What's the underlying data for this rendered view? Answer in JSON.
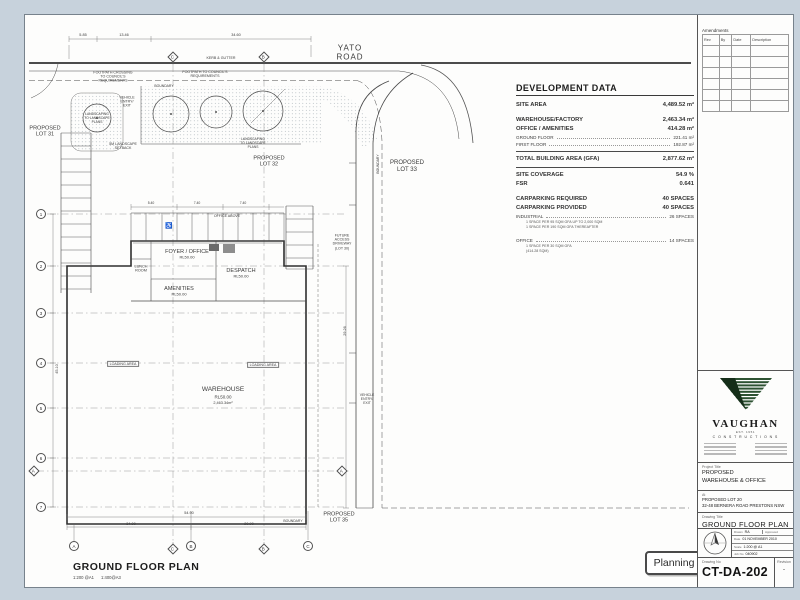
{
  "colors": {
    "page_bg": "#c7d2dc",
    "sheet": "#fdfdfc",
    "ink": "#3c3c3c",
    "logo_stripe_green": "#2d5232",
    "logo_solid": "#152e19",
    "stamp_border": "#4a4a4a"
  },
  "plan_title": {
    "text": "GROUND FLOOR PLAN",
    "scale": "1:200 @A1      1:400@A3"
  },
  "stamp": {
    "label": "Planning"
  },
  "development_data": {
    "title": "DEVELOPMENT DATA",
    "rows": [
      {
        "t": "r",
        "label": "SITE AREA",
        "value": "4,489.52 m²"
      },
      {
        "t": "gap"
      },
      {
        "t": "r",
        "label": "WAREHOUSE/FACTORY",
        "value": "2,463.34 m²"
      },
      {
        "t": "r",
        "label": "OFFICE / AMENITIES",
        "value": "414.28 m²"
      },
      {
        "t": "s",
        "label": "GROUND FLOOR",
        "value": "221.41 m²"
      },
      {
        "t": "s",
        "label": "FIRST FLOOR",
        "value": "192.87 m²"
      },
      {
        "t": "rule"
      },
      {
        "t": "r",
        "label": "TOTAL BUILDING AREA (GFA)",
        "value": "2,877.62 m²"
      },
      {
        "t": "rule"
      },
      {
        "t": "r",
        "label": "SITE COVERAGE",
        "value": "54.9 %"
      },
      {
        "t": "r",
        "label": "FSR",
        "value": "0.641"
      },
      {
        "t": "gap"
      },
      {
        "t": "r",
        "label": "CARPARKING REQUIRED",
        "value": "40 SPACES"
      },
      {
        "t": "r",
        "label": "CARPARKING PROVIDED",
        "value": "40 SPACES"
      },
      {
        "t": "s",
        "label": "INDUSTRIAL",
        "value": "26 SPACES"
      },
      {
        "t": "n",
        "label": "1 SPACE PER 95 SQM GFA UP TO 2,000 SQM"
      },
      {
        "t": "n",
        "label": "1 SPACE PER 190 SQM GFA THEREAFTER"
      },
      {
        "t": "gap"
      },
      {
        "t": "s",
        "label": "OFFICE",
        "value": "14 SPACES"
      },
      {
        "t": "n",
        "label": "1 SPACE PER 30 SQM GFA"
      },
      {
        "t": "n",
        "label": "(414.28 SQM)"
      }
    ]
  },
  "titleblock": {
    "amendments": {
      "title": "Amendments",
      "columns": [
        "Rev",
        "By",
        "Date",
        "Description"
      ],
      "empty_rows": 6
    },
    "logo": {
      "name": "VAUGHAN",
      "est": "EST. 1951",
      "sub": "C O N S T R U C T I O N S"
    },
    "project_label": "Project Title",
    "project_line1": "PROPOSED",
    "project_line2": "WAREHOUSE & OFFICE",
    "at_label": "At",
    "at_line1": "PROPOSED LOT 20",
    "at_line2": "32-48 BERNERA ROAD PRESTONS NSW",
    "drawing_title_label": "Drawing Title",
    "drawing_title": "GROUND FLOOR PLAN",
    "fields": {
      "drawn_label": "Drawn",
      "drawn": "RA",
      "approved_label": "Approved",
      "approved": "",
      "date_label": "Date",
      "date": "01 NOVEMBER 2010",
      "scale_label": "Scale",
      "scale": "1:200 @ A1",
      "job_label": "Job No",
      "job": "040902"
    },
    "drawing_no_label": "Drawing No",
    "drawing_no": "CT-DA-202",
    "revision_label": "Revision",
    "revision": "-"
  },
  "plan": {
    "labels": [
      {
        "n": "yato-road-label",
        "t": "YATO\nROAD",
        "x": 349,
        "y": 52,
        "s": 8,
        "ls": 1
      },
      {
        "n": "lot-31-label",
        "t": "PROPOSED\nLOT 31",
        "x": 44,
        "y": 131,
        "s": 5.5
      },
      {
        "n": "lot-32-label",
        "t": "PROPOSED\nLOT 32",
        "x": 268,
        "y": 161,
        "s": 5.5
      },
      {
        "n": "lot-33-label",
        "t": "PROPOSED\nLOT 33",
        "x": 406,
        "y": 166,
        "s": 6
      },
      {
        "n": "lot-35-label",
        "t": "PROPOSED\nLOT 35",
        "x": 338,
        "y": 517,
        "s": 5.5
      },
      {
        "n": "warehouse-label",
        "t": "WAREHOUSE",
        "x": 222,
        "y": 389,
        "s": 6.5
      },
      {
        "n": "warehouse-rl-label",
        "t": "RL50.00",
        "x": 222,
        "y": 396,
        "s": 4.5
      },
      {
        "n": "warehouse-area-label",
        "t": "2,463.34m²",
        "x": 222,
        "y": 402,
        "s": 3.8
      },
      {
        "n": "foyer-office-label",
        "t": "FOYER / OFFICE",
        "x": 186,
        "y": 251,
        "s": 5.5
      },
      {
        "n": "foyer-office-rl-label",
        "t": "RL50.00",
        "x": 186,
        "y": 257,
        "s": 4
      },
      {
        "n": "despatch-label",
        "t": "DESPATCH",
        "x": 240,
        "y": 270,
        "s": 5.5
      },
      {
        "n": "despatch-rl-label",
        "t": "RL50.00",
        "x": 240,
        "y": 276,
        "s": 4
      },
      {
        "n": "amenities-label",
        "t": "AMENITIES",
        "x": 178,
        "y": 288,
        "s": 5.5
      },
      {
        "n": "amenities-rl-label",
        "t": "RL50.00",
        "x": 178,
        "y": 294,
        "s": 4
      },
      {
        "n": "lunch-room-label",
        "t": "LUNCH\nROOM",
        "x": 140,
        "y": 268,
        "s": 3.8
      },
      {
        "n": "office-above-label",
        "t": "OFFICE ABOVE",
        "x": 226,
        "y": 215,
        "s": 3.6
      },
      {
        "n": "loading-area-1-label",
        "t": "LOADING AREA",
        "x": 122,
        "y": 363,
        "s": 3.6,
        "box": true
      },
      {
        "n": "loading-area-2-label",
        "t": "LOADING AREA",
        "x": 262,
        "y": 364,
        "s": 3.6,
        "box": true
      },
      {
        "n": "kerb-gutter-label",
        "t": "KERB & GUTTER",
        "x": 220,
        "y": 57,
        "s": 3.6
      },
      {
        "n": "footpath-crossing-label",
        "t": "FOOTPATH CROSSING\nTO COUNCIL'S\nREQUIREMENTS",
        "x": 112,
        "y": 76,
        "s": 3.6
      },
      {
        "n": "footpath-label",
        "t": "FOOTPATH TO COUNCIL'S\nREQUIREMENTS",
        "x": 204,
        "y": 73,
        "s": 3.6
      },
      {
        "n": "boundary-top-label",
        "t": "BOUNDARY",
        "x": 163,
        "y": 85,
        "s": 3.4
      },
      {
        "n": "boundary-right-label",
        "t": "BOUNDARY",
        "x": 377,
        "y": 163,
        "s": 3.4,
        "rot": -90
      },
      {
        "n": "boundary-bottom-label",
        "t": "BOUNDARY",
        "x": 292,
        "y": 520,
        "s": 3.4
      },
      {
        "n": "vehicle-entry-top-label",
        "t": "VEHICLE\nENTRY/\nEXIT",
        "x": 126,
        "y": 101,
        "s": 3.6
      },
      {
        "n": "landscaping-1-label",
        "t": "LANDSCAPING\nTO LANDSCAPE\nPLANS",
        "x": 96,
        "y": 118,
        "s": 3.3
      },
      {
        "n": "landscaping-2-label",
        "t": "LANDSCAPING\nTO LANDSCAPE\nPLANS",
        "x": 252,
        "y": 143,
        "s": 3.3
      },
      {
        "n": "landscape-setback-label",
        "t": "5M LANDSCAPE\nSETBACK",
        "x": 122,
        "y": 145,
        "s": 3.6
      },
      {
        "n": "future-access-label",
        "t": "FUTURE\nACCESS\nDRIVEWAY\n(LOT 30)",
        "x": 341,
        "y": 241,
        "s": 3.6
      },
      {
        "n": "vehicle-entry-right-label",
        "t": "VEHICLE\nENTRY/\nEXIT",
        "x": 366,
        "y": 398,
        "s": 3.4
      },
      {
        "n": "dim-top-1",
        "t": "5.85",
        "x": 82,
        "y": 34,
        "s": 3.8
      },
      {
        "n": "dim-top-2",
        "t": "13.46",
        "x": 123,
        "y": 34,
        "s": 3.8
      },
      {
        "n": "dim-top-3",
        "t": "34.60",
        "x": 235,
        "y": 34,
        "s": 3.8
      },
      {
        "n": "dim-park-1",
        "t": "5.40",
        "x": 150,
        "y": 202,
        "s": 3.4
      },
      {
        "n": "dim-park-2",
        "t": "7.40",
        "x": 196,
        "y": 202,
        "s": 3.4
      },
      {
        "n": "dim-park-3",
        "t": "7.40",
        "x": 242,
        "y": 202,
        "s": 3.4
      },
      {
        "n": "dim-bottom-total",
        "t": "54.90",
        "x": 188,
        "y": 512,
        "s": 3.8
      },
      {
        "n": "dim-bottom-1",
        "t": "34.00",
        "x": 130,
        "y": 523,
        "s": 3.8
      },
      {
        "n": "dim-bottom-2",
        "t": "20.90",
        "x": 248,
        "y": 523,
        "s": 3.8
      },
      {
        "n": "dim-left-total",
        "t": "45.10",
        "x": 56,
        "y": 368,
        "s": 3.8,
        "rot": -90
      },
      {
        "n": "dim-right-1",
        "t": "29.26",
        "x": 344,
        "y": 330,
        "s": 3.8,
        "rot": -90
      },
      {
        "n": "disabled-parking-icon",
        "t": "♿",
        "x": 168,
        "y": 226,
        "s": 6
      }
    ],
    "grid_bubbles": [
      {
        "l": "1",
        "sh": "c",
        "x": 40,
        "y": 213
      },
      {
        "l": "2",
        "sh": "c",
        "x": 40,
        "y": 265
      },
      {
        "l": "3",
        "sh": "c",
        "x": 40,
        "y": 312
      },
      {
        "l": "4",
        "sh": "c",
        "x": 40,
        "y": 362
      },
      {
        "l": "5",
        "sh": "c",
        "x": 40,
        "y": 407
      },
      {
        "l": "6",
        "sh": "c",
        "x": 40,
        "y": 457
      },
      {
        "l": "7",
        "sh": "c",
        "x": 40,
        "y": 506
      },
      {
        "l": "A",
        "sh": "d",
        "x": 33,
        "y": 470
      },
      {
        "l": "A",
        "sh": "d",
        "x": 341,
        "y": 470
      },
      {
        "l": "C",
        "sh": "d",
        "x": 172,
        "y": 56
      },
      {
        "l": "B",
        "sh": "d",
        "x": 263,
        "y": 56
      },
      {
        "l": "A",
        "sh": "c",
        "x": 73,
        "y": 545
      },
      {
        "l": "C",
        "sh": "d",
        "x": 172,
        "y": 548
      },
      {
        "l": "B",
        "sh": "c",
        "x": 190,
        "y": 545
      },
      {
        "l": "B",
        "sh": "d",
        "x": 263,
        "y": 548
      },
      {
        "l": "C",
        "sh": "c",
        "x": 307,
        "y": 545
      }
    ]
  }
}
